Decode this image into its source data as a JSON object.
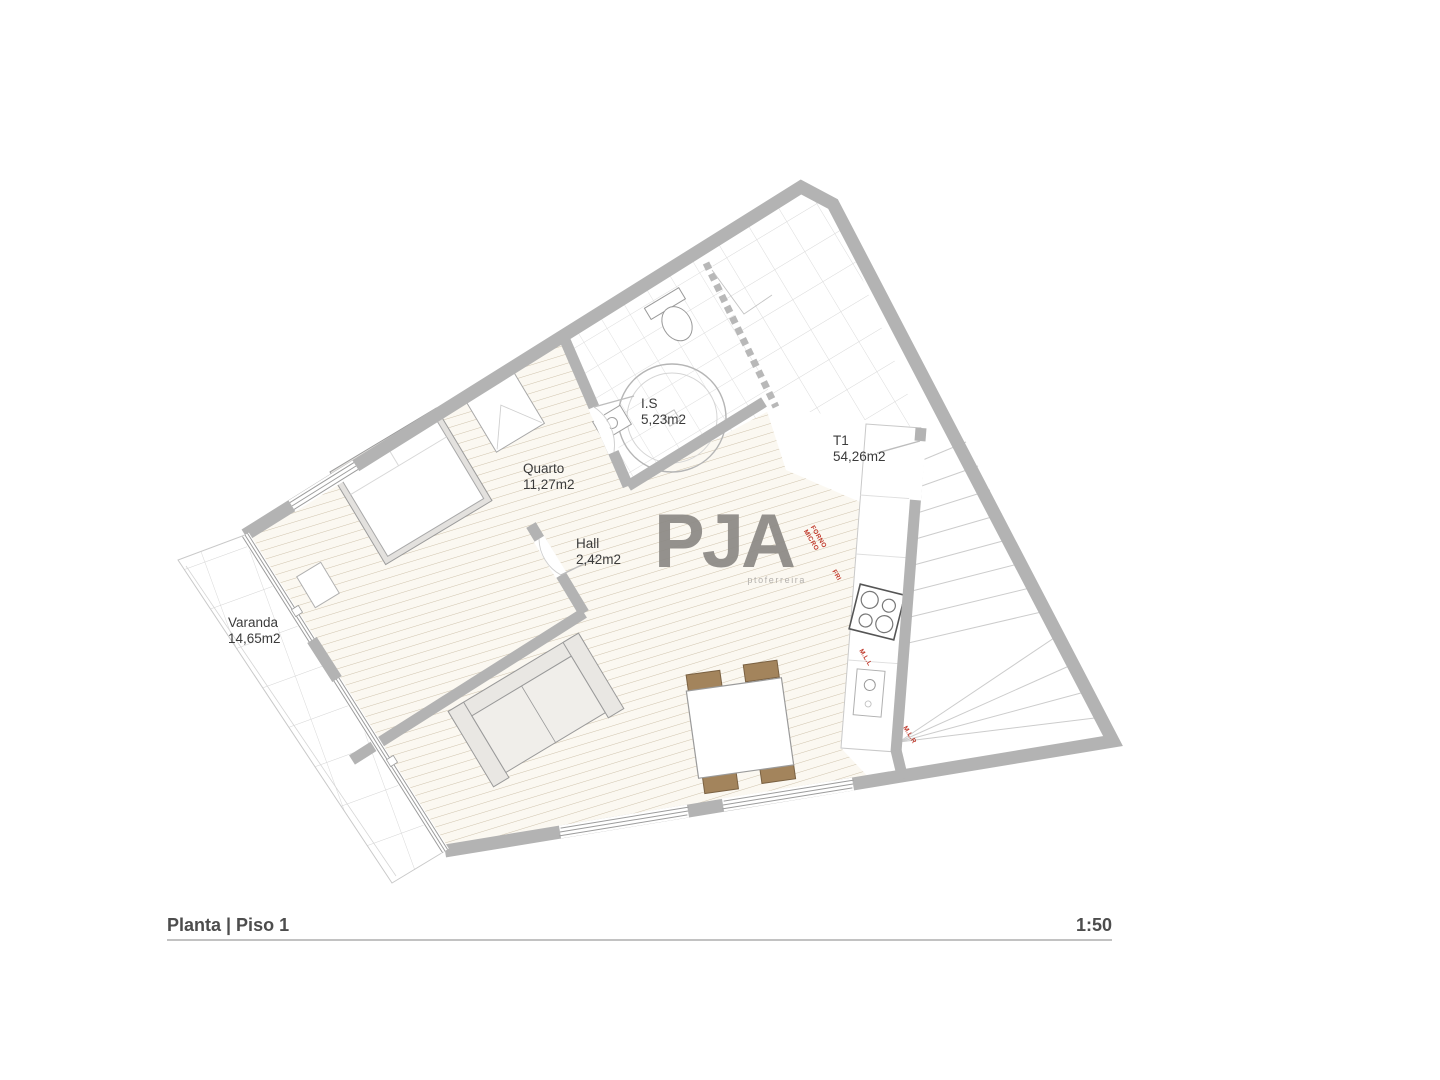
{
  "drawing": {
    "title": "Planta | Piso 1",
    "scale": "1:50"
  },
  "logo": {
    "name": "PJA",
    "subtitle": "ptoferreira"
  },
  "rooms": {
    "is": {
      "name": "I.S",
      "area": "5,23m2"
    },
    "quarto": {
      "name": "Quarto",
      "area": "11,27m2"
    },
    "hall": {
      "name": "Hall",
      "area": "2,42m2"
    },
    "t1": {
      "name": "T1",
      "area": "54,26m2"
    },
    "varanda": {
      "name": "Varanda",
      "area": "14,65m2"
    }
  },
  "kitchen": {
    "oven": "FORNO",
    "microwave": "MICRO",
    "fridge": "FRI",
    "dishwasher": "M.L.L",
    "washer": "M.L.R"
  },
  "colors": {
    "wall": "#b3b3b3",
    "wood_line": "#b3a07e",
    "grid_line": "#d9d9d9",
    "appliance_label": "#c0392b",
    "room_text": "#3b3b3b",
    "title_text": "#4d4d4d",
    "logo": "#8d8a86",
    "chair_wood": "#a3845c"
  }
}
